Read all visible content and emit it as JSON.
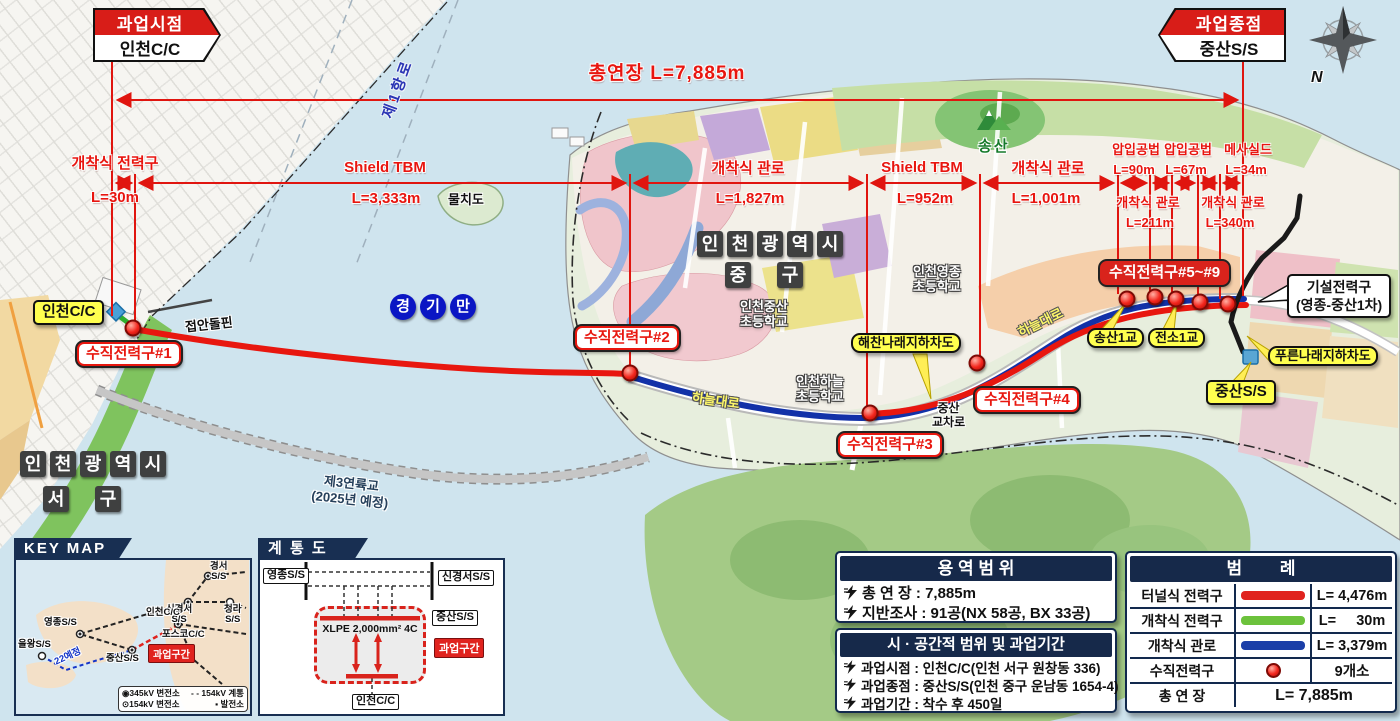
{
  "colors": {
    "route_red": "#e8170f",
    "route_blue": "#1231a8",
    "route_green": "#2fae2f",
    "navy": "#16294a",
    "yellow": "#ffff4f"
  },
  "banner_start": {
    "title": "과업시점",
    "name": "인천C/C"
  },
  "banner_end": {
    "title": "과업종점",
    "name": "중산S/S"
  },
  "compass_n": "N",
  "dim_total": "총연장 L=7,885m",
  "sections": [
    {
      "method": "개착식 전력구",
      "length": "L=30m"
    },
    {
      "method": "Shield TBM",
      "length": "L=3,333m"
    },
    {
      "method": "개착식 관로",
      "length": "L=1,827m"
    },
    {
      "method": "Shield TBM",
      "length": "L=952m"
    },
    {
      "method": "개착식 관로",
      "length": "L=1,001m"
    },
    {
      "method": "압입공법",
      "length": "L=90m"
    },
    {
      "method": "압입공법",
      "length": "L=67m"
    },
    {
      "method": "메사실드",
      "length": "L=34m"
    },
    {
      "method": "개착식 관로",
      "length": "L=211m"
    },
    {
      "method": "개착식 관로",
      "length": "L=340m"
    }
  ],
  "map": {
    "sea_lane": "제1항로",
    "island": "물치도",
    "bay": "경기만",
    "jung_gu_line1": "인천광역시",
    "jung_gu_line2": "중구",
    "seo_gu_line1": "인천광역시",
    "seo_gu_line2": "서구",
    "incheon_cc": "인천C/C",
    "pier": "접안돌핀",
    "bridge3_line1": "제3연륙교",
    "bridge3_line2": "(2025년 예정)",
    "shaft1": "수직전력구#1",
    "shaft2": "수직전력구#2",
    "shaft3": "수직전력구#3",
    "shaft4": "수직전력구#4",
    "shaft5_9": "수직전력구#5~#9",
    "underpass_haechan": "해찬나래지하차도",
    "underpass_pureun": "푸른나래지하차도",
    "songsan_br": "송산1교",
    "jeonso_br": "전소1교",
    "existing_line1": "기설전력구",
    "existing_line2": "(영종-중산1차)",
    "jungsan_ss": "중산S/S",
    "songsan_mt": "송산",
    "road1": "하늘대로",
    "road2": "하늘대로",
    "junction_line1": "중산",
    "junction_line2": "교차로",
    "school_jungsan_line1": "인천중산",
    "school_jungsan_line2": "초등학교",
    "school_yeongjong_line1": "인천영종",
    "school_yeongjong_line2": "초등학교",
    "school_haneul_line1": "인천하늘",
    "school_haneul_line2": "초등학교"
  },
  "keymap": {
    "title": "KEY MAP",
    "st_gyeongseo_1": "경서",
    "st_gyeongseo_2": "S/S",
    "st_singyeongseo_1": "신경서",
    "st_singyeongseo_2": "S/S",
    "st_cheongna_1": "청라",
    "st_cheongna_2": "S/S",
    "st_yeongjong": "영종S/S",
    "st_incheon": "인천C/C",
    "st_posco": "포스코C/C",
    "st_eolwang": "을왕S/S",
    "st_jungsan": "중산S/S",
    "badge": "과업구간",
    "planned": "22예정",
    "leg_345_icon": "◉",
    "leg_345": "345kV 변전소",
    "leg_system_icon": "- -",
    "leg_system": "154kV 계통",
    "leg_154_icon": "⊙",
    "leg_154": "154kV 변전소",
    "leg_plant_icon": "▪",
    "leg_plant": "발전소"
  },
  "diagram": {
    "title": "계 통 도",
    "yeongjong": "영종S/S",
    "singyeongseo": "신경서S/S",
    "jungsan": "중산S/S",
    "incheon": "인천C/C",
    "cable": "XLPE 2,000mm²  4C",
    "badge": "과업구간"
  },
  "scope": {
    "title": "용 역 범 위",
    "row1": "총 연 장 : 7,885m",
    "row2": "지반조사 : 91공(NX 58공, BX 33공)"
  },
  "period": {
    "title": "시 · 공간적 범위 및 과업기간",
    "row1": "과업시점 : 인천C/C(인천 서구 원창동 336)",
    "row2": "과업종점 : 중산S/S(인천 중구 운남동 1654-4)",
    "row3": "과업기간 : 착수 후 450일"
  },
  "legend": {
    "title": "범        례",
    "rows": [
      {
        "label": "터널식 전력구",
        "value": "L= 4,476m"
      },
      {
        "label": "개착식 전력구",
        "value": "L=     30m"
      },
      {
        "label": "개착식 관로",
        "value": "L= 3,379m"
      },
      {
        "label": "수직전력구",
        "value": "9개소"
      },
      {
        "label": "총 연 장",
        "value": "L= 7,885m"
      }
    ]
  }
}
